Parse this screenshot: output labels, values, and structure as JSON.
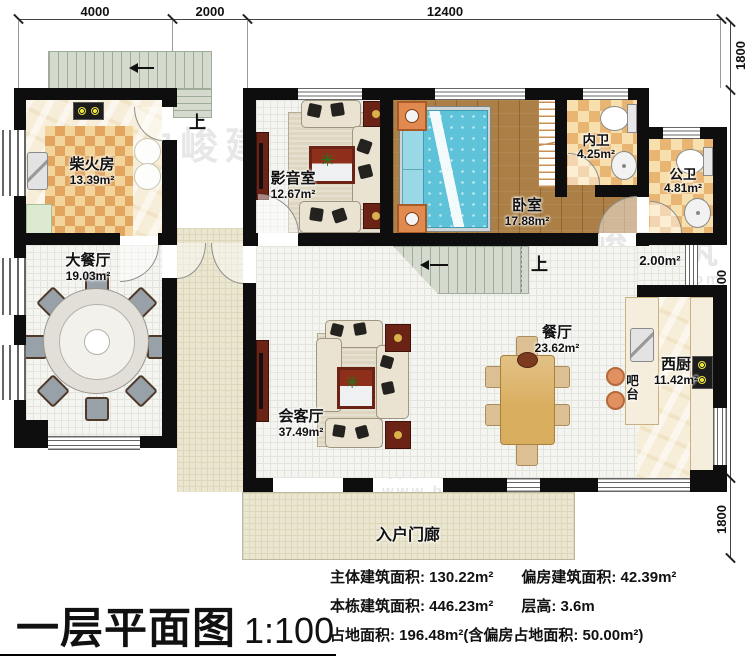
{
  "title": {
    "name": "一层平面图",
    "scale": "1:100"
  },
  "dims": {
    "top": [
      "4000",
      "2000",
      "12400"
    ],
    "right": [
      "1800",
      "10300",
      "1800"
    ]
  },
  "rooms": {
    "chaihuofang": {
      "name": "柴火房",
      "area": "13.39m²"
    },
    "dacanting": {
      "name": "大餐厅",
      "area": "19.03m²"
    },
    "yingyinshi": {
      "name": "影音室",
      "area": "12.67m²"
    },
    "woshi": {
      "name": "卧室",
      "area": "17.88m²"
    },
    "neiwei": {
      "name": "内卫",
      "area": "4.25m²"
    },
    "gongwei": {
      "name": "公卫",
      "area": "4.81m²"
    },
    "canting": {
      "name": "餐厅",
      "area": "23.62m²"
    },
    "huiketing": {
      "name": "会客厅",
      "area": "37.49m²"
    },
    "xichu": {
      "name": "西厨",
      "area": "11.42m²"
    },
    "batai": {
      "name": "吧台"
    },
    "menlang": {
      "name": "入户门廊"
    },
    "nook": {
      "area": "2.00m²"
    }
  },
  "stairs": {
    "up_exterior": "上",
    "up_interior": "上"
  },
  "icons": {
    "plant": "✳"
  },
  "stats": {
    "main_area": "主体建筑面积: 130.22m²",
    "annex_area": "偏房建筑面积: 42.39m²",
    "building_area": "本栋建筑面积: 446.23m²",
    "floor_height": "层高: 3.6m",
    "footprint": "占地面积: 196.48m²(含偏房占地面积: 50.00m²)"
  },
  "watermark": {
    "brand": "柏峻建筑",
    "url": "www.baijunjz.com"
  }
}
